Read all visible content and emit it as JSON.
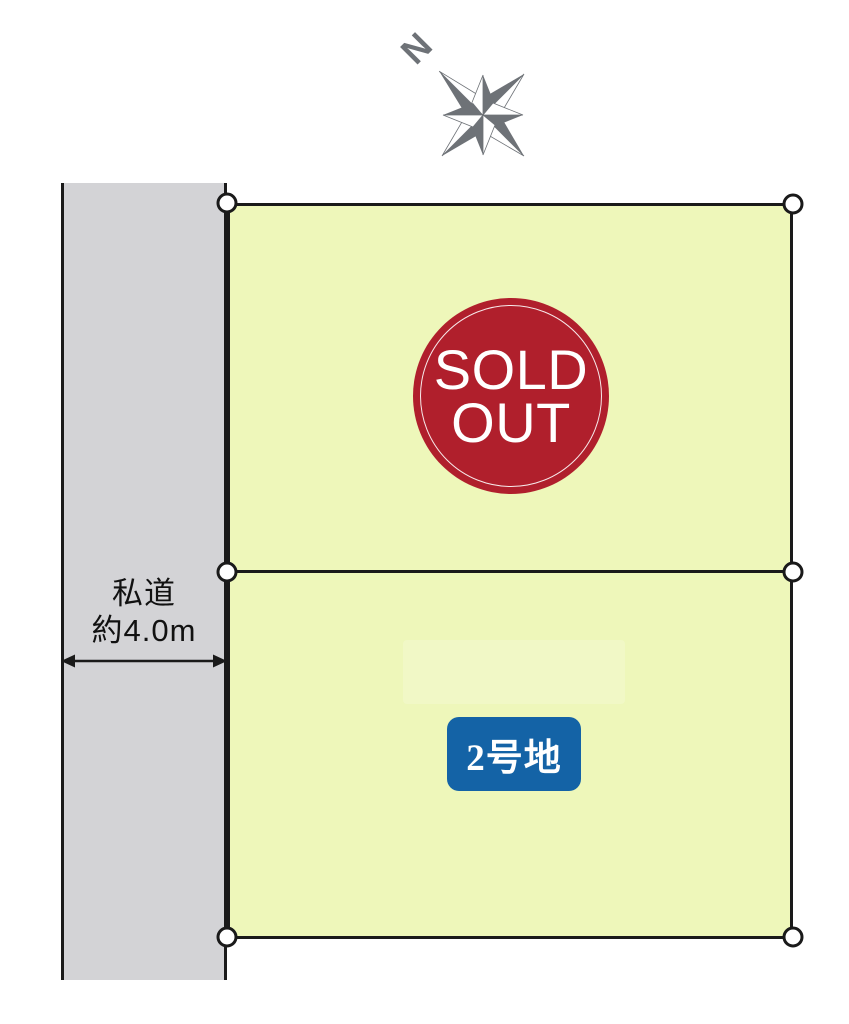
{
  "compass": {
    "label": "N",
    "color": "#6e7277"
  },
  "road": {
    "label_line1": "私道",
    "label_line2": "約4.0m",
    "fill": "#d3d3d6"
  },
  "parcels": {
    "fill": "#eef7ba",
    "sold_lot": {
      "badge_line1": "SOLD",
      "badge_line2": "OUT",
      "badge_color": "#b01f2c"
    },
    "lot2": {
      "label": "2号地",
      "label_bg": "#1463a6"
    }
  },
  "colors": {
    "parcel_fill": "#eef7ba",
    "road_fill": "#d3d3d6",
    "badge_red": "#b01f2c",
    "lot_blue": "#1463a6",
    "line_color": "#1a1a1a",
    "compass_gray": "#6e7277"
  }
}
